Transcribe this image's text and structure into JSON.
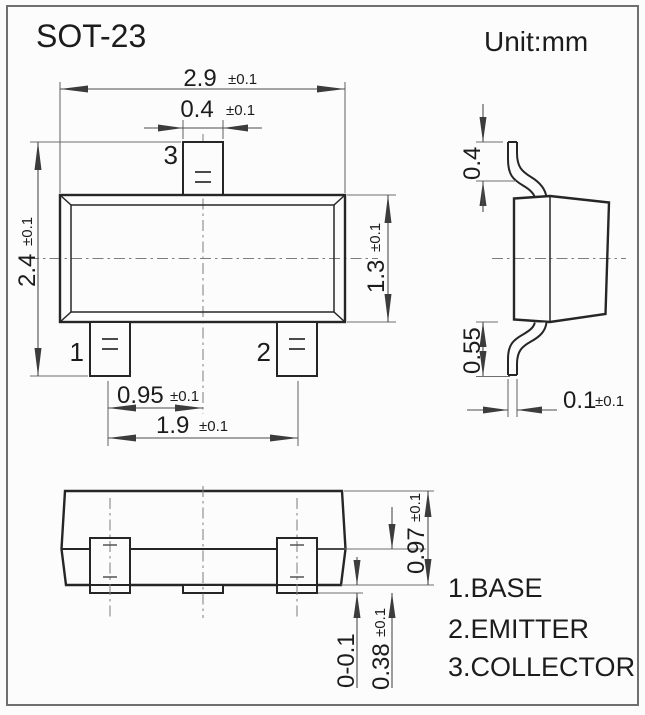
{
  "title": "SOT-23",
  "unit_label": "Unit:mm",
  "colors": {
    "outline": "#262626",
    "dimension": "#4d4d4d",
    "background": "#fcfcfc"
  },
  "views": {
    "top": {
      "pin_labels": {
        "pin1": "1",
        "pin2": "2",
        "pin3": "3"
      },
      "dims": {
        "body_width": {
          "value": "2.9",
          "tol": "±0.1"
        },
        "lead3_width": {
          "value": "0.4",
          "tol": "±0.1"
        },
        "overall_depth": {
          "value": "2.4",
          "tol": "±0.1"
        },
        "body_depth": {
          "value": "1.3",
          "tol": "±0.1"
        },
        "lead_offset": {
          "value": "0.95",
          "tol": "±0.1"
        },
        "lead_span": {
          "value": "1.9",
          "tol": "±0.1"
        }
      }
    },
    "side": {
      "dims": {
        "upper_lead_height": {
          "value": "0.4",
          "tol": ""
        },
        "lower_lead_height": {
          "value": "0.55",
          "tol": ""
        },
        "lead_thickness": {
          "value": "0.1",
          "tol": "±0.1"
        }
      }
    },
    "front": {
      "dims": {
        "body_height": {
          "value": "0.97",
          "tol": "±0.1"
        },
        "lead_height": {
          "value": "0.38",
          "tol": "±0.1"
        },
        "standoff": {
          "value": "0-0.1",
          "tol": ""
        }
      }
    }
  },
  "legend": [
    "1.BASE",
    "2.EMITTER",
    "3.COLLECTOR"
  ]
}
